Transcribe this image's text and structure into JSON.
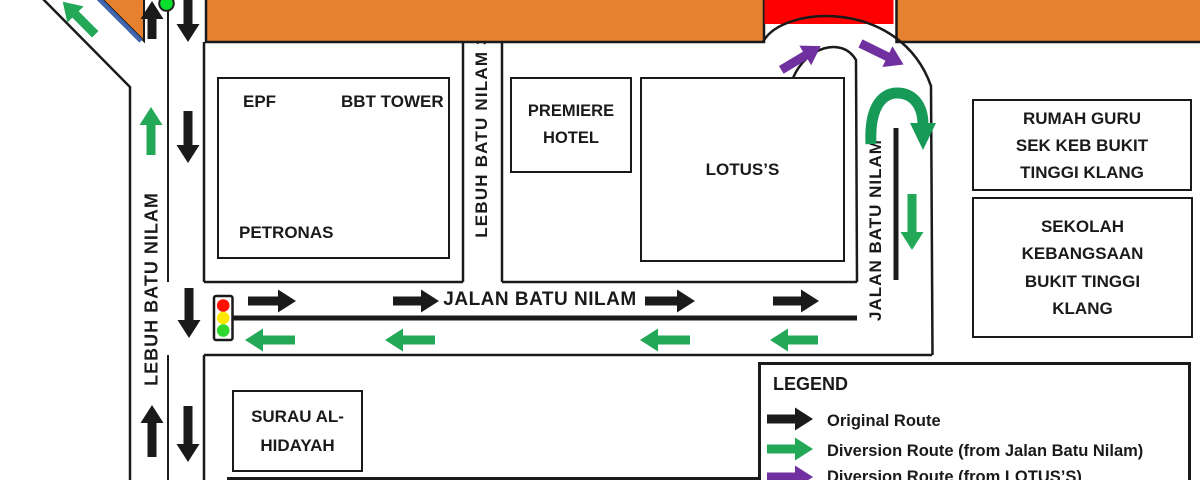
{
  "roads": {
    "lebuh_batu_nilam": "LEBUH BATU NILAM",
    "lebuh_batu_nilam_3": "LEBUH BATU NILAM 3",
    "jalan_batu_nilam_horizontal": "JALAN BATU NILAM",
    "jalan_batu_nilam_vertical": "JALAN BATU NILAM"
  },
  "buildings": {
    "epf": "EPF",
    "bbt_tower": "BBT TOWER",
    "petronas": "PETRONAS",
    "premiere_hotel": [
      "PREMIERE",
      "HOTEL"
    ],
    "lotus": "LOTUS’S",
    "rumah_guru": [
      "RUMAH GURU",
      "SEK KEB BUKIT",
      "TINGGI KLANG"
    ],
    "sekolah_kebangsaan": [
      "SEKOLAH",
      "KEBANGSAAN",
      "BUKIT TINGGI",
      "KLANG"
    ],
    "surau": [
      "SURAU AL-",
      "HIDAYAH"
    ]
  },
  "legend": {
    "title": "LEGEND",
    "items": [
      {
        "label": "Original Route",
        "color": "black"
      },
      {
        "label": "Diversion Route (from Jalan Batu Nilam)",
        "color": "green"
      },
      {
        "label": "Diversion Route (from LOTUS’S)",
        "color": "purple"
      }
    ]
  },
  "markers": {
    "road_closure_color": "#FE0000",
    "traffic_light_colors": [
      "#FF0F00",
      "#FFE800",
      "#2FD82F"
    ],
    "signal_dot_color": "#0ADF2B"
  },
  "colors": {
    "orange": "#E6812F",
    "red": "#FE0000",
    "black": "#1A1A1A",
    "green": "#23A858",
    "arch_green": "#179958",
    "purple": "#7030A0",
    "blue": "#4064AE"
  },
  "arrows": [
    {
      "x": 152,
      "y": 20,
      "angle": -90,
      "len": 38,
      "color": "black"
    },
    {
      "x": 188,
      "y": 21,
      "angle": 90,
      "len": 42,
      "color": "black"
    },
    {
      "x": 79,
      "y": 18,
      "angle": -135,
      "len": 46,
      "color": "green"
    },
    {
      "x": 151,
      "y": 131,
      "angle": -90,
      "len": 48,
      "color": "green"
    },
    {
      "x": 188,
      "y": 137,
      "angle": 90,
      "len": 52,
      "color": "black"
    },
    {
      "x": 189,
      "y": 313,
      "angle": 90,
      "len": 50,
      "color": "black"
    },
    {
      "x": 152,
      "y": 431,
      "angle": -90,
      "len": 52,
      "color": "black"
    },
    {
      "x": 188,
      "y": 434,
      "angle": 90,
      "len": 56,
      "color": "black"
    },
    {
      "x": 272,
      "y": 301,
      "angle": 0,
      "len": 48,
      "color": "black"
    },
    {
      "x": 416,
      "y": 301,
      "angle": 0,
      "len": 46,
      "color": "black"
    },
    {
      "x": 670,
      "y": 301,
      "angle": 0,
      "len": 50,
      "color": "black"
    },
    {
      "x": 796,
      "y": 301,
      "angle": 0,
      "len": 46,
      "color": "black"
    },
    {
      "x": 270,
      "y": 340,
      "angle": 180,
      "len": 50,
      "color": "green"
    },
    {
      "x": 410,
      "y": 340,
      "angle": 180,
      "len": 50,
      "color": "green"
    },
    {
      "x": 665,
      "y": 340,
      "angle": 180,
      "len": 50,
      "color": "green"
    },
    {
      "x": 794,
      "y": 340,
      "angle": 180,
      "len": 48,
      "color": "green"
    },
    {
      "x": 912,
      "y": 222,
      "angle": 90,
      "len": 56,
      "color": "green"
    },
    {
      "x": 801,
      "y": 58,
      "angle": -31,
      "len": 46,
      "color": "purple"
    },
    {
      "x": 882,
      "y": 54,
      "angle": 26,
      "len": 48,
      "color": "purple"
    },
    {
      "x": 790,
      "y": 419,
      "angle": 0,
      "len": 46,
      "color": "black"
    },
    {
      "x": 790,
      "y": 449,
      "angle": 0,
      "len": 46,
      "color": "green"
    },
    {
      "x": 790,
      "y": 477,
      "angle": 0,
      "len": 46,
      "color": "purple"
    }
  ]
}
